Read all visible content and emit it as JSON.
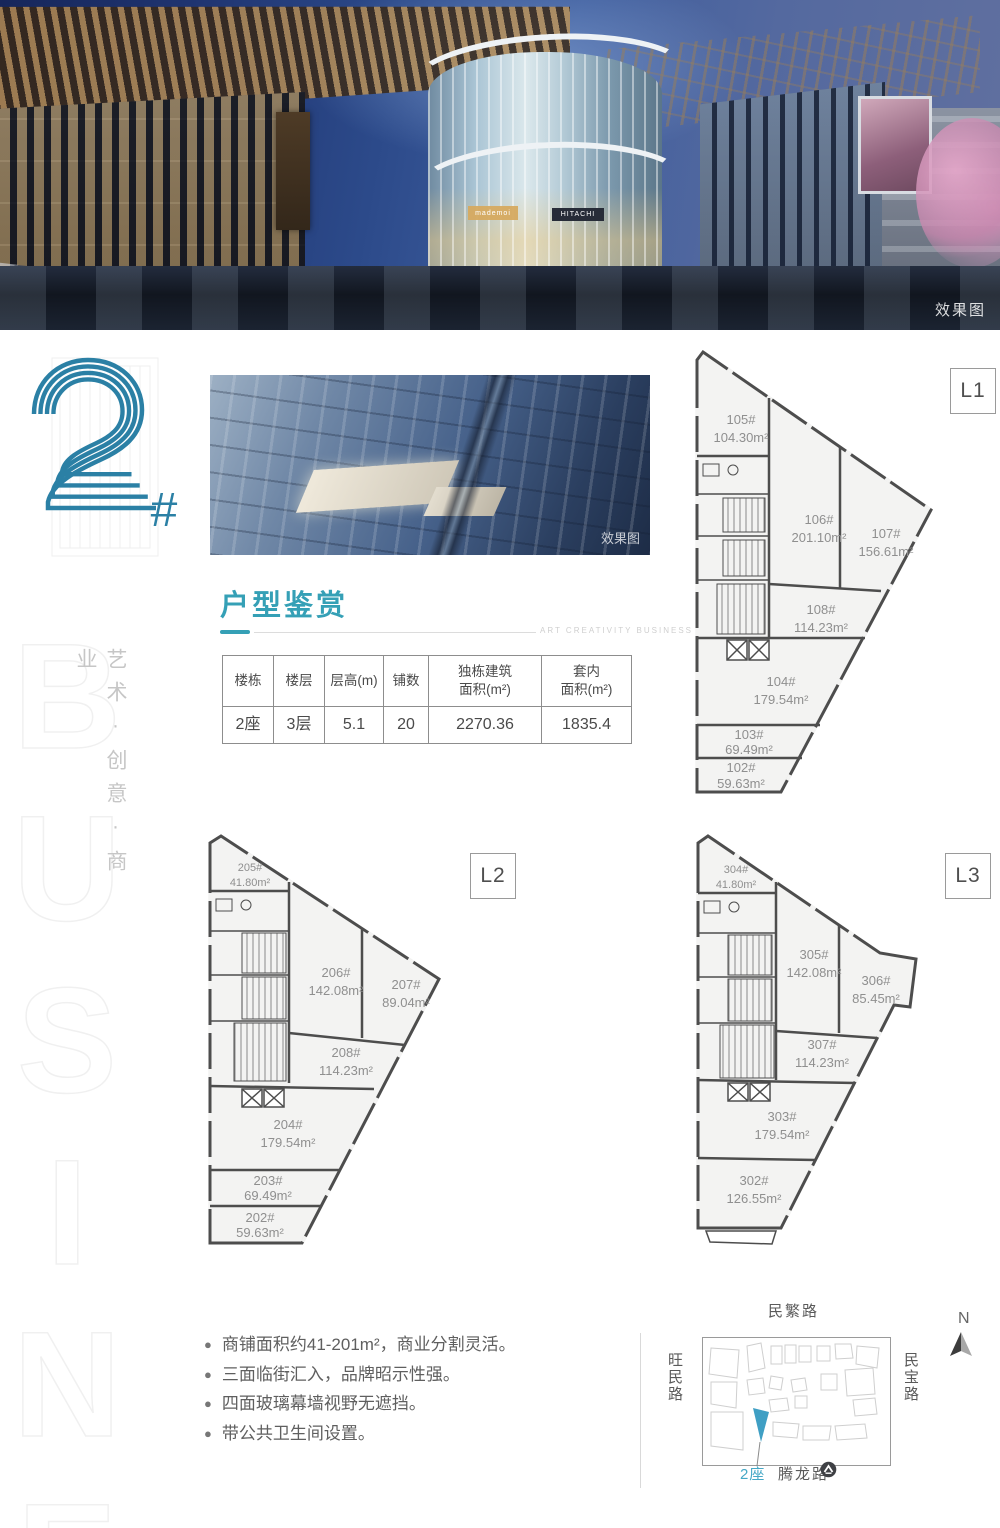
{
  "colors": {
    "accent": "#35a0b6",
    "logo": "#2b80a5",
    "map_highlight": "#3f9fc4"
  },
  "hero": {
    "watermark": "效果图",
    "sign1": "mademoi",
    "sign2": "HITACHI"
  },
  "aerial": {
    "watermark": "效果图"
  },
  "logo": {
    "number": "2",
    "suffix": "#"
  },
  "side": {
    "slogan": "艺术·创意·商业",
    "watermark": "BUSINESS"
  },
  "section": {
    "title": "户型鉴赏",
    "tagline": "ART CREATIVITY BUSINESS"
  },
  "table": {
    "headers": [
      {
        "line1": "楼栋",
        "line2": ""
      },
      {
        "line1": "楼层",
        "line2": ""
      },
      {
        "line1": "层高(m)",
        "line2": ""
      },
      {
        "line1": "铺数",
        "line2": ""
      },
      {
        "line1": "独栋建筑",
        "line2": "面积(m²)"
      },
      {
        "line1": "套内",
        "line2": "面积(m²)"
      }
    ],
    "row": [
      "2座",
      "3层",
      "5.1",
      "20",
      "2270.36",
      "1835.4"
    ]
  },
  "plans": {
    "l1": {
      "label": "L1",
      "units": [
        {
          "no": "105#",
          "area": "104.30m²"
        },
        {
          "no": "106#",
          "area": "201.10m²"
        },
        {
          "no": "107#",
          "area": "156.61m²"
        },
        {
          "no": "108#",
          "area": "114.23m²"
        },
        {
          "no": "104#",
          "area": "179.54m²"
        },
        {
          "no": "103#",
          "area": "69.49m²"
        },
        {
          "no": "102#",
          "area": "59.63m²"
        }
      ]
    },
    "l2": {
      "label": "L2",
      "units": [
        {
          "no": "205#",
          "area": "41.80m²"
        },
        {
          "no": "206#",
          "area": "142.08m²"
        },
        {
          "no": "207#",
          "area": "89.04m²"
        },
        {
          "no": "208#",
          "area": "114.23m²"
        },
        {
          "no": "204#",
          "area": "179.54m²"
        },
        {
          "no": "203#",
          "area": "69.49m²"
        },
        {
          "no": "202#",
          "area": "59.63m²"
        }
      ]
    },
    "l3": {
      "label": "L3",
      "units": [
        {
          "no": "304#",
          "area": "41.80m²"
        },
        {
          "no": "305#",
          "area": "142.08m²"
        },
        {
          "no": "306#",
          "area": "85.45m²"
        },
        {
          "no": "307#",
          "area": "114.23m²"
        },
        {
          "no": "303#",
          "area": "179.54m²"
        },
        {
          "no": "302#",
          "area": "126.55m²"
        }
      ]
    }
  },
  "features": [
    "商铺面积约41-201m²，商业分割灵活。",
    "三面临街汇入，品牌昭示性强。",
    "四面玻璃幕墙视野无遮挡。",
    "带公共卫生间设置。"
  ],
  "map": {
    "road_top": "民繁路",
    "road_left": "旺民路",
    "road_right": "民宝路",
    "road_bottom": "腾龙路",
    "building": "2座",
    "north": "N"
  }
}
